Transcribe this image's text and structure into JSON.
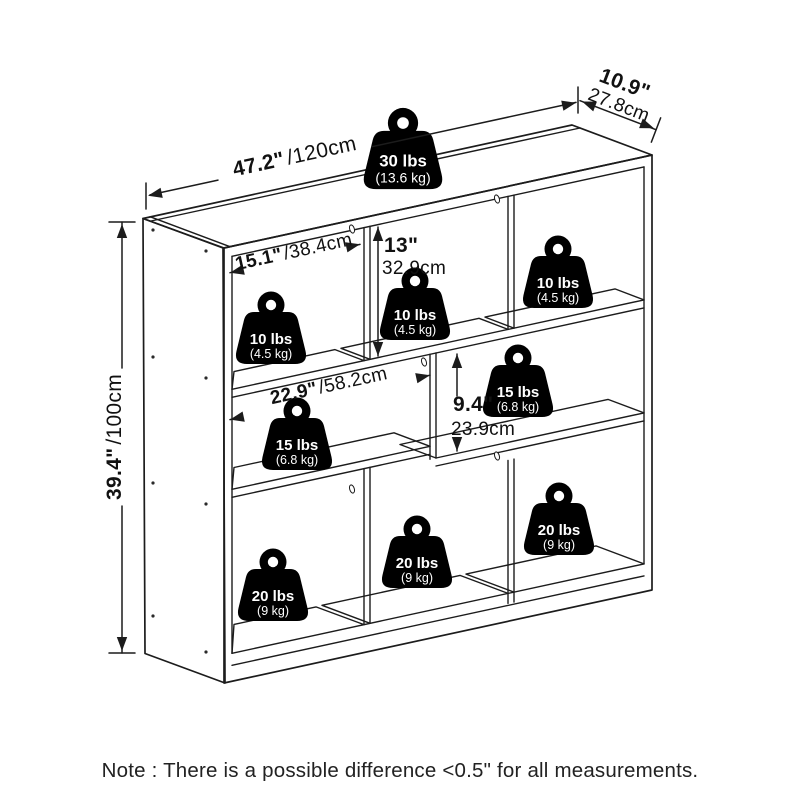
{
  "note": "Note : There is a possible difference <0.5\" for all measurements.",
  "dimensions": {
    "width": {
      "in": "47.2\"",
      "cm": "/120cm"
    },
    "depth": {
      "in": "10.9\"",
      "cm": "27.8cm"
    },
    "height": {
      "in": "39.4\"",
      "cm": "/100cm"
    },
    "top_left_cubby_width": {
      "in": "15.1\"",
      "cm": "/38.4cm"
    },
    "top_row_height": {
      "in": "13\"",
      "cm": "32.9cm"
    },
    "middle_cubby_width": {
      "in": "22.9\"",
      "cm": "/58.2cm"
    },
    "middle_right_cubby_height": {
      "in": "9.4\"",
      "cm": "23.9cm"
    }
  },
  "weight_capacities": {
    "top_surface": {
      "lbs": "30 lbs",
      "kg": "(13.6 kg)"
    },
    "top_left": {
      "lbs": "10 lbs",
      "kg": "(4.5 kg)"
    },
    "top_middle": {
      "lbs": "10 lbs",
      "kg": "(4.5 kg)"
    },
    "top_right": {
      "lbs": "10 lbs",
      "kg": "(4.5 kg)"
    },
    "middle_left": {
      "lbs": "15 lbs",
      "kg": "(6.8 kg)"
    },
    "middle_right": {
      "lbs": "15 lbs",
      "kg": "(6.8 kg)"
    },
    "bottom_left": {
      "lbs": "20 lbs",
      "kg": "(9 kg)"
    },
    "bottom_middle": {
      "lbs": "20 lbs",
      "kg": "(9 kg)"
    },
    "bottom_right": {
      "lbs": "20 lbs",
      "kg": "(9 kg)"
    }
  },
  "colors": {
    "line": "#1c1c1c",
    "background": "#ffffff",
    "badge": "#000000"
  }
}
